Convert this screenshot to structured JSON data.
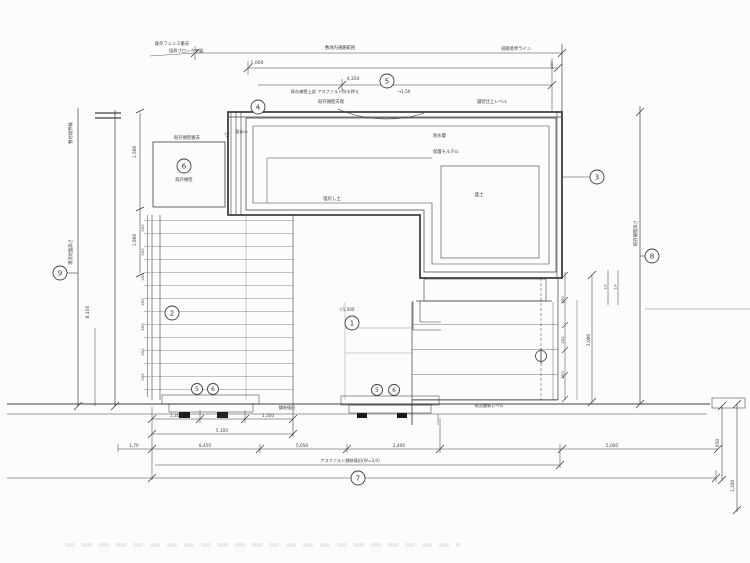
{
  "document": {
    "kind": "construction-section-scan",
    "title": "擁壁・舗装断面図"
  },
  "colors": {
    "linework": "#3f3f3f",
    "dark_ink": "#2c2c2c",
    "paper": "#fcfcfb",
    "hatch_fill": "#e2e2dd",
    "strip_fill": "#555555"
  },
  "labels": [
    {
      "t": "既存フェンス撤去",
      "x": 172,
      "y": 45,
      "s": 4.3
    },
    {
      "t": "境界ブロック天端",
      "x": 186,
      "y": 52.5,
      "s": 4.3
    },
    {
      "t": "敷地内通路範囲",
      "x": 340,
      "y": 49,
      "s": 4.3
    },
    {
      "t": "道路境界ライン",
      "x": 516,
      "y": 50,
      "s": 4.3
    },
    {
      "t": "1,000",
      "x": 257,
      "y": 64,
      "s": 4.5
    },
    {
      "t": "4,350",
      "x": 353,
      "y": 80,
      "s": 4.5
    },
    {
      "t": "既存擁壁上部 アスファルト防水押え",
      "x": 325,
      "y": 93,
      "s": 4.2
    },
    {
      "t": "→1,50",
      "x": 404,
      "y": 93,
      "s": 4.2
    },
    {
      "t": "既存擁壁天端",
      "x": 331,
      "y": 103,
      "s": 4.3
    },
    {
      "t": "舗装仕上レベル",
      "x": 492,
      "y": 103,
      "s": 4.3
    },
    {
      "t": "▽",
      "x": 227,
      "y": 137,
      "s": 6.5
    },
    {
      "t": "既存GL",
      "x": 242,
      "y": 133,
      "s": 3.8
    },
    {
      "t": "防水層",
      "x": 433,
      "y": 137,
      "s": 4.3,
      "a": "start"
    },
    {
      "t": "保護モルタル",
      "x": 433,
      "y": 153,
      "s": 4.3,
      "a": "start"
    },
    {
      "t": "埋戻し土",
      "x": 332,
      "y": 200,
      "s": 4.5
    },
    {
      "t": "盛土",
      "x": 479,
      "y": 196,
      "s": 4.5
    },
    {
      "t": "既存擁壁撤去",
      "x": 187,
      "y": 139,
      "s": 4.3
    },
    {
      "t": "既存擁壁",
      "x": 184,
      "y": 181,
      "s": 4.3,
      "c": "#222222"
    },
    {
      "t": "敷地境界線",
      "x": 72,
      "y": 133,
      "r": -90,
      "s": 4.3,
      "c": "#222222"
    },
    {
      "t": "現況地盤高さ",
      "x": 72,
      "y": 252,
      "r": -90,
      "s": 4.3
    },
    {
      "t": "8,100",
      "x": 89,
      "y": 312,
      "r": -90,
      "s": 4.5
    },
    {
      "t": "1,500",
      "x": 136,
      "y": 152,
      "r": -90,
      "s": 4.3
    },
    {
      "t": "1,900",
      "x": 136,
      "y": 240,
      "r": -90,
      "s": 4.3
    },
    {
      "t": "250",
      "x": 144,
      "y": 228,
      "r": -90,
      "s": 3.8
    },
    {
      "t": "250",
      "x": 144,
      "y": 252,
      "r": -90,
      "s": 3.8
    },
    {
      "t": "250",
      "x": 144,
      "y": 277,
      "r": -90,
      "s": 3.8
    },
    {
      "t": "250",
      "x": 144,
      "y": 302,
      "r": -90,
      "s": 3.8
    },
    {
      "t": "250",
      "x": 144,
      "y": 327,
      "r": -90,
      "s": 3.8
    },
    {
      "t": "250",
      "x": 144,
      "y": 352,
      "r": -90,
      "s": 3.8
    },
    {
      "t": "250",
      "x": 144,
      "y": 377,
      "r": -90,
      "s": 3.8
    },
    {
      "t": "▽1,500",
      "x": 347,
      "y": 311,
      "s": 4.2
    },
    {
      "t": "舗装復旧",
      "x": 287,
      "y": 409,
      "s": 4.2,
      "c": "#222222"
    },
    {
      "t": "現況舗装レベル",
      "x": 489,
      "y": 407,
      "s": 4.2
    },
    {
      "t": "1,350",
      "x": 176,
      "y": 417,
      "s": 4.3
    },
    {
      "t": "1,350",
      "x": 222,
      "y": 417,
      "s": 4.3
    },
    {
      "t": "1,350",
      "x": 268,
      "y": 417,
      "s": 4.3
    },
    {
      "t": "5,100",
      "x": 222,
      "y": 432,
      "s": 4.3
    },
    {
      "t": "1,70",
      "x": 134,
      "y": 447,
      "s": 4.2
    },
    {
      "t": "8,450",
      "x": 205,
      "y": 447,
      "s": 4.3
    },
    {
      "t": "5,050",
      "x": 302,
      "y": 447,
      "s": 4.3
    },
    {
      "t": "2,400",
      "x": 399,
      "y": 447,
      "s": 4.3
    },
    {
      "t": "5,000",
      "x": 612,
      "y": 447,
      "s": 4.3
    },
    {
      "t": "アスファルト舗装復旧(W=3,0)",
      "x": 350,
      "y": 462,
      "s": 4.2
    },
    {
      "t": "250",
      "x": 564,
      "y": 300,
      "r": -90,
      "s": 3.8
    },
    {
      "t": "250",
      "x": 564,
      "y": 340,
      "r": -90,
      "s": 3.8
    },
    {
      "t": "250",
      "x": 564,
      "y": 375,
      "r": -90,
      "s": 3.8
    },
    {
      "t": "3,000",
      "x": 590,
      "y": 340,
      "r": -90,
      "s": 4.3
    },
    {
      "t": "T.P",
      "x": 607,
      "y": 287,
      "r": -90,
      "s": 3.8
    },
    {
      "t": "T.P",
      "x": 617,
      "y": 287,
      "r": -90,
      "s": 3.8
    },
    {
      "t": "既存擁壁高さ",
      "x": 637,
      "y": 233,
      "r": -90,
      "s": 4.3
    },
    {
      "t": "650",
      "x": 719,
      "y": 443,
      "r": -90,
      "s": 4.3
    },
    {
      "t": "1,100",
      "x": 734,
      "y": 486,
      "r": -90,
      "s": 4.3
    },
    {
      "t": "190",
      "x": 553,
      "y": 65,
      "r": -90,
      "s": 3.8
    }
  ],
  "callouts": [
    {
      "n": "5",
      "x": 387,
      "y": 81,
      "r": 7
    },
    {
      "n": "4",
      "x": 258,
      "y": 107,
      "r": 7
    },
    {
      "n": "6",
      "x": 184,
      "y": 166,
      "r": 7
    },
    {
      "n": "3",
      "x": 597,
      "y": 177,
      "r": 7
    },
    {
      "n": "8",
      "x": 652,
      "y": 256,
      "r": 7
    },
    {
      "n": "9",
      "x": 60,
      "y": 273,
      "r": 7
    },
    {
      "n": "2",
      "x": 172,
      "y": 313,
      "r": 7
    },
    {
      "n": "1",
      "x": 352,
      "y": 323,
      "r": 7
    },
    {
      "n": "7",
      "x": 358,
      "y": 478,
      "r": 7
    },
    {
      "n": "5",
      "x": 197,
      "y": 389,
      "r": 5.5
    },
    {
      "n": "6",
      "x": 213,
      "y": 389,
      "r": 5.5
    },
    {
      "n": "5",
      "x": 377,
      "y": 390,
      "r": 5.5
    },
    {
      "n": "6",
      "x": 394,
      "y": 390,
      "r": 5.5
    }
  ]
}
